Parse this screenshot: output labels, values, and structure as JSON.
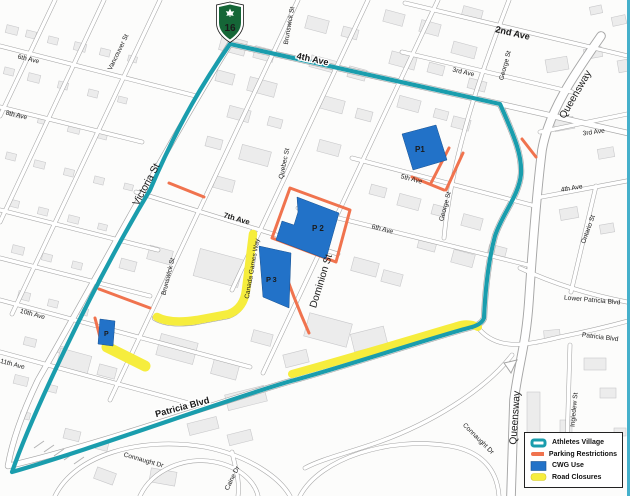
{
  "shield": {
    "number": "16"
  },
  "lots": {
    "p1": "P1",
    "p2": "P2",
    "p3": "P3",
    "p": "P"
  },
  "streets": {
    "ave2": "2nd Ave",
    "ave3a": "3rd Ave",
    "ave3b": "3rd Ave",
    "ave4": "4th Ave",
    "ave4e": "4th Ave",
    "ave5": "5th Ave",
    "ave6w": "6th Ave",
    "ave6": "6th Ave",
    "ave7": "7th Ave",
    "ave8": "8th Ave",
    "ave10": "10th Ave",
    "ave11": "11th Ave",
    "victoria": "Victoria St",
    "vancouver": "Vancouver St",
    "brunswickN": "Brunswick St",
    "brunswickS": "Brunswick St",
    "quebec": "Quebec St",
    "dominion": "Dominion St",
    "georgeN": "George St",
    "georgeS": "George St",
    "queenswayN": "Queensway",
    "queenswayS": "Queensway",
    "ontario": "Ontario St",
    "ingledew": "Ingledew St",
    "lowerPatricia": "Lower Patricia Blvd",
    "patriciaE": "Patricia Blvd",
    "patricia": "Patricia Blvd",
    "canadaGames": "Canada Games Way",
    "connaught1": "Connaught Dr",
    "connaught2": "Connaught Dr",
    "caine": "Caine Dr"
  },
  "legend": {
    "items": [
      {
        "label": "Athletes Village"
      },
      {
        "label": "Parking Restrictions"
      },
      {
        "label": "CWG Use"
      },
      {
        "label": "Road Closures"
      }
    ]
  },
  "colors": {
    "village": "#1A9DAD",
    "parking": "#F0734E",
    "cwg": "#2272C8",
    "closure": "#F6ED3D"
  }
}
